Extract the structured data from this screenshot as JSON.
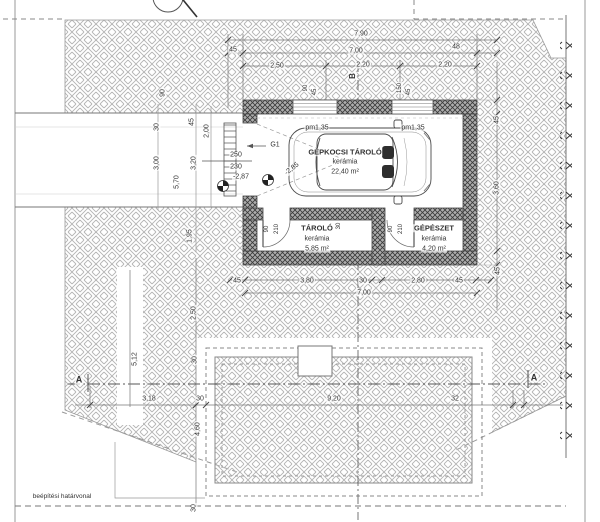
{
  "colors": {
    "text": "#333333",
    "line": "#555555",
    "wall_fill": "#adadad",
    "hatch": "#b4b4b4"
  },
  "plan": {
    "grid_axis": "B",
    "section_marker": "A",
    "garage_door": "G1",
    "parapet": "pm1,35",
    "boundary": "beépítési határvonal",
    "rooms": [
      {
        "name": "GÉPKOCSI TÁROLÓ",
        "finish": "kerámia",
        "area": "22,40 m²"
      },
      {
        "name": "TÁROLÓ",
        "finish": "kerámia",
        "area": "5,85 m²"
      },
      {
        "name": "GÉPÉSZET",
        "finish": "kerámia",
        "area": "4,20 m²"
      }
    ],
    "levels": {
      "sill_top": "250",
      "sill_bottom": "230",
      "drive": "-2,87",
      "garage": "-2,85"
    },
    "dims": {
      "total_width": "7,90",
      "top": [
        "45",
        "7,00",
        "48"
      ],
      "openings_top": [
        "2,50",
        "2,20",
        "2,20"
      ],
      "window_left": [
        "90",
        "45"
      ],
      "window_right": [
        "150",
        "45"
      ],
      "left_drive": [
        "90",
        "30",
        "45",
        "2,00",
        "3,00",
        "3,20",
        "5,70",
        "1,95"
      ],
      "bottom_garage": [
        "45",
        "3,80",
        "30",
        "2,80",
        "45"
      ],
      "bottom_total": "7,00",
      "right": [
        "45",
        "3,60",
        "45"
      ],
      "left_site": [
        "2,50",
        "5,12",
        "30",
        "4,60",
        "30"
      ],
      "site_row": [
        "3,18",
        "30",
        "9,20",
        "32"
      ],
      "mid_wall": "30",
      "door": [
        "90",
        "210"
      ]
    }
  },
  "annotations": [
    {
      "name": "dim-total-width",
      "ref": "plan.dims.total_width",
      "x": 361,
      "y": 34
    },
    {
      "name": "dim-top-45",
      "ref": "plan.dims.top.0",
      "x": 233,
      "y": 50
    },
    {
      "name": "dim-top-700",
      "ref": "plan.dims.top.1",
      "x": 356,
      "y": 51
    },
    {
      "name": "dim-top-48",
      "ref": "plan.dims.top.2",
      "x": 456,
      "y": 47
    },
    {
      "name": "dim-opening-250",
      "ref": "plan.dims.openings_top.0",
      "x": 277,
      "y": 66
    },
    {
      "name": "dim-opening-220a",
      "ref": "plan.dims.openings_top.1",
      "x": 363,
      "y": 65
    },
    {
      "name": "dim-opening-220b",
      "ref": "plan.dims.openings_top.2",
      "x": 445,
      "y": 65
    },
    {
      "name": "grid-axis-label",
      "ref": "plan.grid_axis",
      "x": 353,
      "y": 76,
      "rot": -90,
      "size": 8,
      "bold": true
    },
    {
      "name": "dim-win-l-90",
      "ref": "plan.dims.window_left.0",
      "x": 306,
      "y": 88,
      "rot": -90,
      "size": 6
    },
    {
      "name": "dim-win-l-45",
      "ref": "plan.dims.window_left.1",
      "x": 315,
      "y": 92,
      "rot": -90,
      "size": 6
    },
    {
      "name": "dim-win-r-150",
      "ref": "plan.dims.window_right.0",
      "x": 400,
      "y": 88,
      "rot": -90,
      "size": 6
    },
    {
      "name": "dim-win-r-45",
      "ref": "plan.dims.window_right.1",
      "x": 409,
      "y": 92,
      "rot": -90,
      "size": 6
    },
    {
      "name": "dim-drive-90",
      "ref": "plan.dims.left_drive.0",
      "x": 163,
      "y": 93,
      "rot": -90
    },
    {
      "name": "dim-drive-30",
      "ref": "plan.dims.left_drive.1",
      "x": 157,
      "y": 127,
      "rot": -90
    },
    {
      "name": "dim-drive-45",
      "ref": "plan.dims.left_drive.2",
      "x": 192,
      "y": 122,
      "rot": -90
    },
    {
      "name": "dim-drive-200",
      "ref": "plan.dims.left_drive.3",
      "x": 207,
      "y": 131,
      "rot": -90
    },
    {
      "name": "dim-drive-300",
      "ref": "plan.dims.left_drive.4",
      "x": 157,
      "y": 163,
      "rot": -90
    },
    {
      "name": "dim-drive-320",
      "ref": "plan.dims.left_drive.5",
      "x": 194,
      "y": 163,
      "rot": -90
    },
    {
      "name": "dim-drive-570",
      "ref": "plan.dims.left_drive.6",
      "x": 177,
      "y": 182,
      "rot": -90
    },
    {
      "name": "dim-drive-195",
      "ref": "plan.dims.left_drive.7",
      "x": 190,
      "y": 236,
      "rot": -90
    },
    {
      "name": "level-sill-top",
      "ref": "plan.levels.sill_top",
      "x": 236,
      "y": 155
    },
    {
      "name": "level-sill-bottom",
      "ref": "plan.levels.sill_bottom",
      "x": 236,
      "y": 167
    },
    {
      "name": "level-drive",
      "ref": "plan.levels.drive",
      "x": 241,
      "y": 177
    },
    {
      "name": "garage-door-label",
      "ref": "plan.garage_door",
      "x": 275,
      "y": 145
    },
    {
      "name": "parapet-left",
      "ref": "plan.parapet",
      "x": 317,
      "y": 128
    },
    {
      "name": "parapet-right",
      "ref": "plan.parapet",
      "x": 413,
      "y": 128
    },
    {
      "name": "level-garage",
      "ref": "plan.levels.garage",
      "x": 292,
      "y": 169,
      "rot": -38
    },
    {
      "name": "room-garage-name",
      "ref": "plan.rooms.0.name",
      "x": 345,
      "y": 152,
      "size": 7.5,
      "bold": true
    },
    {
      "name": "room-garage-finish",
      "ref": "plan.rooms.0.finish",
      "x": 345,
      "y": 162
    },
    {
      "name": "room-garage-area",
      "ref": "plan.rooms.0.area",
      "x": 345,
      "y": 172
    },
    {
      "name": "room-storage-name",
      "ref": "plan.rooms.1.name",
      "x": 317,
      "y": 228,
      "size": 7.5,
      "bold": true
    },
    {
      "name": "room-storage-finish",
      "ref": "plan.rooms.1.finish",
      "x": 317,
      "y": 239
    },
    {
      "name": "room-storage-area",
      "ref": "plan.rooms.1.area",
      "x": 317,
      "y": 249
    },
    {
      "name": "room-mech-name",
      "ref": "plan.rooms.2.name",
      "x": 434,
      "y": 228,
      "size": 7.5,
      "bold": true
    },
    {
      "name": "room-mech-finish",
      "ref": "plan.rooms.2.finish",
      "x": 434,
      "y": 239
    },
    {
      "name": "room-mech-area",
      "ref": "plan.rooms.2.area",
      "x": 434,
      "y": 249
    },
    {
      "name": "door1-width",
      "ref": "plan.dims.door.0",
      "x": 267,
      "y": 229,
      "rot": -90,
      "size": 6
    },
    {
      "name": "door1-height",
      "ref": "plan.dims.door.1",
      "x": 277,
      "y": 229,
      "rot": -90,
      "size": 6
    },
    {
      "name": "door2-width",
      "ref": "plan.dims.door.0",
      "x": 391,
      "y": 229,
      "rot": -90,
      "size": 6
    },
    {
      "name": "door2-height",
      "ref": "plan.dims.door.1",
      "x": 401,
      "y": 229,
      "rot": -90,
      "size": 6
    },
    {
      "name": "dim-mid-wall",
      "ref": "plan.dims.mid_wall",
      "x": 339,
      "y": 226,
      "rot": -90,
      "size": 6
    },
    {
      "name": "dim-bot-45a",
      "ref": "plan.dims.bottom_garage.0",
      "x": 237,
      "y": 281
    },
    {
      "name": "dim-bot-380",
      "ref": "plan.dims.bottom_garage.1",
      "x": 307,
      "y": 281
    },
    {
      "name": "dim-bot-30",
      "ref": "plan.dims.bottom_garage.2",
      "x": 363,
      "y": 281
    },
    {
      "name": "dim-bot-280",
      "ref": "plan.dims.bottom_garage.3",
      "x": 418,
      "y": 281
    },
    {
      "name": "dim-bot-45b",
      "ref": "plan.dims.bottom_garage.4",
      "x": 459,
      "y": 281
    },
    {
      "name": "dim-bot-total",
      "ref": "plan.dims.bottom_total",
      "x": 364,
      "y": 293
    },
    {
      "name": "dim-right-45a",
      "ref": "plan.dims.right.0",
      "x": 497,
      "y": 120,
      "rot": -90
    },
    {
      "name": "dim-right-360",
      "ref": "plan.dims.right.1",
      "x": 497,
      "y": 188,
      "rot": -90
    },
    {
      "name": "dim-right-45b",
      "ref": "plan.dims.right.2",
      "x": 498,
      "y": 271,
      "rot": -90
    },
    {
      "name": "dim-site-250",
      "ref": "plan.dims.left_site.0",
      "x": 194,
      "y": 313,
      "rot": -90
    },
    {
      "name": "dim-site-512",
      "ref": "plan.dims.left_site.1",
      "x": 135,
      "y": 359,
      "rot": -90
    },
    {
      "name": "dim-site-30a",
      "ref": "plan.dims.left_site.2",
      "x": 195,
      "y": 360,
      "rot": -90
    },
    {
      "name": "dim-site-460",
      "ref": "plan.dims.left_site.3",
      "x": 198,
      "y": 429,
      "rot": -90
    },
    {
      "name": "dim-site-30b",
      "ref": "plan.dims.left_site.4",
      "x": 194,
      "y": 508,
      "rot": -90
    },
    {
      "name": "dim-row-318",
      "ref": "plan.dims.site_row.0",
      "x": 149,
      "y": 399
    },
    {
      "name": "dim-row-30",
      "ref": "plan.dims.site_row.1",
      "x": 200,
      "y": 399
    },
    {
      "name": "dim-row-920",
      "ref": "plan.dims.site_row.2",
      "x": 334,
      "y": 399
    },
    {
      "name": "dim-row-32",
      "ref": "plan.dims.site_row.3",
      "x": 455,
      "y": 399
    },
    {
      "name": "section-a-left",
      "ref": "plan.section_marker",
      "x": 79,
      "y": 380,
      "size": 9,
      "bold": true
    },
    {
      "name": "section-a-right",
      "ref": "plan.section_marker",
      "x": 534,
      "y": 378,
      "size": 9,
      "bold": true
    },
    {
      "name": "boundary-label",
      "ref": "plan.boundary",
      "x": 62,
      "y": 497,
      "size": 6.5
    }
  ]
}
